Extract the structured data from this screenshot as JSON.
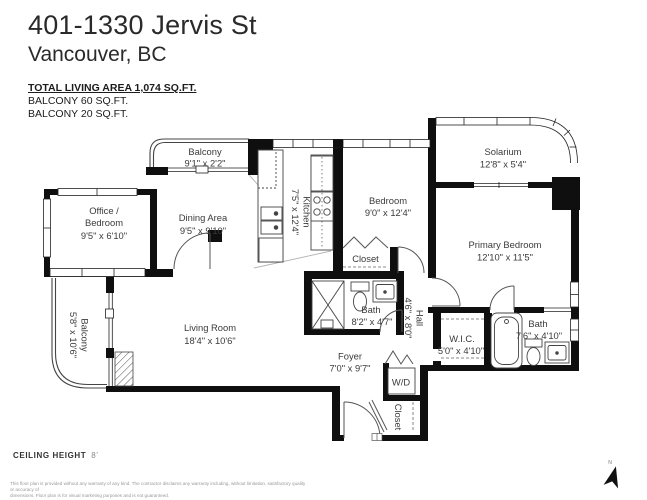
{
  "header": {
    "address_line1": "401-1330 Jervis St",
    "address_line2": "Vancouver, BC",
    "total_area": "TOTAL LIVING AREA 1,074 SQ.FT.",
    "balcony_area_1": "BALCONY 60 SQ.FT.",
    "balcony_area_2": "BALCONY 20 SQ.FT."
  },
  "rooms": {
    "balcony_top": {
      "name": "Balcony",
      "dims": "9'1\" x 2'2\""
    },
    "office": {
      "name_line1": "Office /",
      "name_line2": "Bedroom",
      "dims": "9'5\" x 6'10\""
    },
    "dining": {
      "name": "Dining Area",
      "dims": "9'5\" x 9'10\""
    },
    "kitchen": {
      "name": "Kitchen",
      "dims": "7'5\" x 12'4\""
    },
    "bedroom": {
      "name": "Bedroom",
      "dims": "9'0\" x 12'4\""
    },
    "bedroom_closet": {
      "name": "Closet"
    },
    "solarium": {
      "name": "Solarium",
      "dims": "12'8\" x 5'4\""
    },
    "primary_bedroom": {
      "name": "Primary Bedroom",
      "dims": "12'10\" x 11'5\""
    },
    "main_bath": {
      "name": "Bath",
      "dims": "8'2\" x 4'7\""
    },
    "hall": {
      "name": "Hall",
      "dims": "4'6\" x 8'0\""
    },
    "wic": {
      "name": "W.I.C.",
      "dims": "5'0\" x 4'10\""
    },
    "ensuite_bath": {
      "name": "Bath",
      "dims": "7'6\" x 4'10\""
    },
    "living_room": {
      "name": "Living Room",
      "dims": "18'4\" x 10'6\""
    },
    "balcony_left": {
      "name": "Balcony",
      "dims": "5'8\" x 10'6\""
    },
    "foyer": {
      "name": "Foyer",
      "dims": "7'0\" x 9'7\""
    },
    "washer_dryer": {
      "name": "W/D"
    },
    "entry_closet": {
      "name": "Closet"
    }
  },
  "footer": {
    "ceiling_label": "CEILING HEIGHT",
    "ceiling_value": "8'",
    "disclaimer_line1": "This floor plan is provided without any warranty of any kind. The contractor disclaims any warranty including, without limitation, satisfactory quality or accuracy of",
    "disclaimer_line2": "dimensions. Floor plan is for visual marketing purposes and is not guaranteed."
  },
  "compass": {
    "north_label": "N"
  }
}
